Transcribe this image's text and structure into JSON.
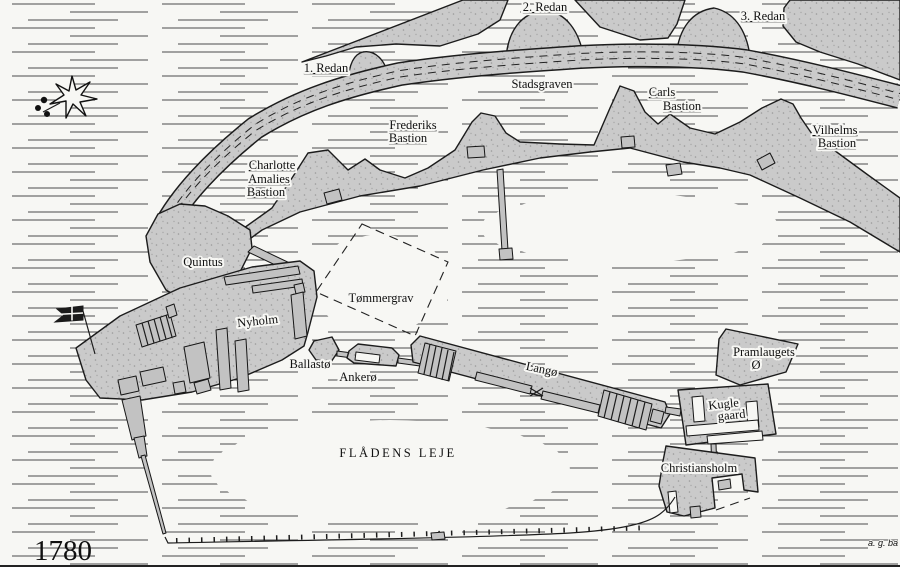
{
  "map": {
    "title_year": "1780",
    "signature": "a. g. ba",
    "colors": {
      "land": "#cacaca",
      "outline": "#1c1c1c",
      "water_line": "#4b4b4b",
      "stipple": "#9a9a9a",
      "flag": "#1a1a1a",
      "paper": "#f7f7f4"
    },
    "symbols": [
      {
        "id": "compass-rose-icon",
        "desc": "eight-pointed star with leaf ornament"
      },
      {
        "id": "naval-flag-icon",
        "desc": "swallow-tailed flag with cross on pole"
      }
    ],
    "labels": [
      {
        "id": "redan-1",
        "text": "1. Redan",
        "x": 326,
        "y": 72,
        "cls": "u"
      },
      {
        "id": "redan-2",
        "text": "2. Redan",
        "x": 545,
        "y": 11,
        "cls": "u"
      },
      {
        "id": "redan-3",
        "text": "3. Redan",
        "x": 763,
        "y": 20,
        "cls": "u"
      },
      {
        "id": "stadsgraven",
        "text": "Stadsgraven",
        "x": 542,
        "y": 88
      },
      {
        "id": "carls-bastion-line1",
        "text": "Carls",
        "x": 662,
        "y": 96,
        "cls": "u"
      },
      {
        "id": "carls-bastion-line2",
        "text": "Bastion",
        "x": 682,
        "y": 110,
        "cls": "u"
      },
      {
        "id": "frederiks-bastion-line1",
        "text": "Frederiks",
        "x": 413,
        "y": 129,
        "cls": "u"
      },
      {
        "id": "frederiks-bastion-line2",
        "text": "Bastion",
        "x": 408,
        "y": 142,
        "cls": "u"
      },
      {
        "id": "vilhelms-bastion-line1",
        "text": "Vilhelms",
        "x": 835,
        "y": 134,
        "cls": "u"
      },
      {
        "id": "vilhelms-bastion-line2",
        "text": "Bastion",
        "x": 837,
        "y": 147,
        "cls": "u"
      },
      {
        "id": "charlotte-amalies-line1",
        "text": "Charlotte",
        "x": 272,
        "y": 169,
        "cls": "u"
      },
      {
        "id": "charlotte-amalies-line2",
        "text": "Amalies",
        "x": 269,
        "y": 183,
        "cls": "u"
      },
      {
        "id": "charlotte-amalies-line3",
        "text": "Bastion",
        "x": 266,
        "y": 196,
        "cls": "u"
      },
      {
        "id": "quintus",
        "text": "Quintus",
        "x": 203,
        "y": 266
      },
      {
        "id": "nyholm",
        "text": "Nyholm",
        "x": 258,
        "y": 325,
        "rot": -6,
        "size": 13.5
      },
      {
        "id": "tommergrav",
        "text": "Tømmergrav",
        "x": 381,
        "y": 302
      },
      {
        "id": "ballasto",
        "text": "Ballastø",
        "x": 310,
        "y": 368
      },
      {
        "id": "ankero",
        "text": "Ankerø",
        "x": 358,
        "y": 381
      },
      {
        "id": "lango",
        "text": "Langø",
        "x": 541,
        "y": 373,
        "rot": 12,
        "size": 13
      },
      {
        "id": "pramlaugets-o-line1",
        "text": "Pramlaugets",
        "x": 764,
        "y": 356
      },
      {
        "id": "pramlaugets-o-line2",
        "text": "Ø",
        "x": 756,
        "y": 369
      },
      {
        "id": "kugle-gaard-line1",
        "text": "Kugle",
        "x": 724,
        "y": 408,
        "rot": -6
      },
      {
        "id": "kugle-gaard-line2",
        "text": "gaard",
        "x": 732,
        "y": 419,
        "rot": -6
      },
      {
        "id": "christiansholm",
        "text": "Christiansholm",
        "x": 699,
        "y": 472,
        "size": 13
      },
      {
        "id": "fladens-leje",
        "text": "FLÅDENS LEJE",
        "x": 398,
        "y": 457,
        "cls": "caps"
      },
      {
        "id": "year",
        "text": "1780",
        "x": 34,
        "y": 560,
        "cls": "year",
        "anchor": "start"
      },
      {
        "id": "signature",
        "text": "a. g. ba",
        "x": 898,
        "y": 546,
        "cls": "sig",
        "anchor": "end"
      }
    ]
  }
}
